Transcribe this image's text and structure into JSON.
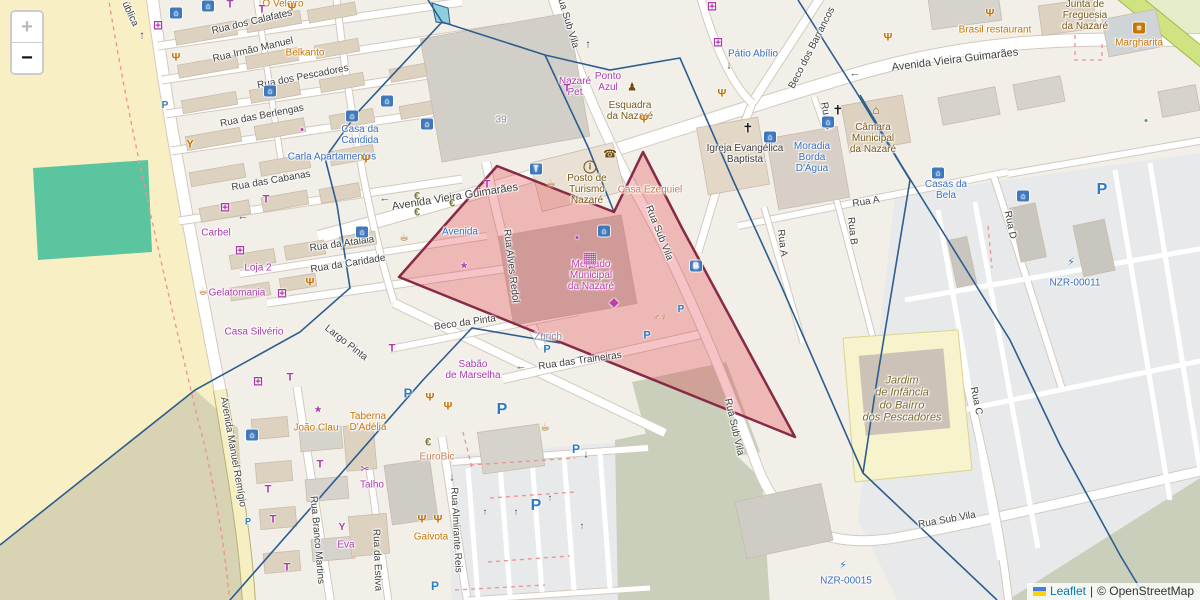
{
  "app": {
    "zoom_in_label": "+",
    "zoom_out_label": "−",
    "attribution": {
      "leaflet": "Leaflet",
      "separator": "|",
      "osm": "© OpenStreetMap"
    }
  },
  "palette": {
    "street": "#3f3f3f",
    "blue": "#3a6fbe",
    "purple": "#ac39ac",
    "orange": "#c77400",
    "brown": "#7a5816",
    "magenta": "#bf3fa8",
    "dark": "#3c3c3c",
    "olive": "#7c6c2c",
    "graylav": "#8a87a0",
    "salmon": "#cc7a52",
    "graynum": "#8f8f8f",
    "bank": "#7c7c3a",
    "pblue": "#2d7cc3",
    "highlight_fill": "rgba(225,55,65,0.30)",
    "highlight_stroke": "#872b45",
    "boundary": "#2d5d8e"
  },
  "icon_defs": {
    "hotel": {
      "glyph": "⌂",
      "fg": "#ffffff",
      "bg": "#3d77bc"
    },
    "taxi": {
      "glyph": "T",
      "fg": "#ffffff",
      "bg": "#3d77bc"
    },
    "bus": {
      "glyph": "B",
      "fg": "#ffffff",
      "bg": "#3d77bc"
    },
    "burger": {
      "glyph": "≡",
      "fg": "#ffffff",
      "bg": "#c77400"
    },
    "shop_clothes": {
      "glyph": "T",
      "fg": "#ac39ac",
      "size": 11
    },
    "shop_grid": {
      "glyph": "⊞",
      "fg": "#ac39ac",
      "size": 12
    },
    "florist": {
      "glyph": "*",
      "fg": "#ac39ac",
      "size": 15
    },
    "scissors": {
      "glyph": "✂",
      "fg": "#ac39ac",
      "size": 11
    },
    "wine": {
      "glyph": "Y",
      "fg": "#ac39ac",
      "size": 10
    },
    "restaurant": {
      "glyph": "Ψ",
      "fg": "#c77400",
      "size": 11
    },
    "cafe": {
      "glyph": "☕",
      "fg": "#a8641e",
      "size": 11
    },
    "bar": {
      "glyph": "Y",
      "fg": "#c77400",
      "size": 11
    },
    "phone": {
      "glyph": "☎",
      "fg": "#734a08",
      "size": 11
    },
    "church": {
      "glyph": "✝",
      "fg": "#1a1a1a",
      "size": 13
    },
    "townhall": {
      "glyph": "⌂",
      "fg": "#734a08",
      "size": 12
    },
    "police": {
      "glyph": "♟",
      "fg": "#734a08",
      "size": 11
    },
    "info": {
      "glyph": "i",
      "fg": "#734a08",
      "size": 9,
      "ring": true
    },
    "atm": {
      "glyph": "€",
      "fg": "#7c7c3a",
      "size": 11
    },
    "wc": {
      "glyph": "♂♀",
      "fg": "#a8641e",
      "size": 10
    },
    "charge": {
      "glyph": "⚡",
      "fg": "#2d7cc3",
      "size": 11
    },
    "fish": {
      "glyph": "◆",
      "fg": "#bf3fa8",
      "size": 12
    },
    "market": {
      "glyph": "▦",
      "fg": "#bf3fa8",
      "size": 15
    },
    "dot": {
      "glyph": "●",
      "fg": "#bf3fa8",
      "size": 7
    },
    "parkP": {
      "glyph": "P",
      "fg": "#2d7cc3",
      "size": 13
    },
    "arrow": {
      "glyph": "←",
      "fg": "#4a4a4a",
      "size": 11
    },
    "lane_arrow": {
      "glyph": "↑",
      "fg": "#333333",
      "size": 9
    }
  },
  "street_labels": [
    {
      "t": "Avenida Vieira Guimarães",
      "x": 455,
      "y": 197,
      "r": -9,
      "s": 11
    },
    {
      "t": "Avenida Vieira Guimarães",
      "x": 955,
      "y": 60,
      "r": -7,
      "s": 11
    },
    {
      "t": "Rua dos Calafates",
      "x": 252,
      "y": 22,
      "r": -13
    },
    {
      "t": "Rua Irmão Manuel",
      "x": 253,
      "y": 50,
      "r": -13
    },
    {
      "t": "Rua dos Pescadores",
      "x": 303,
      "y": 77,
      "r": -11
    },
    {
      "t": "Rua das Berlengas",
      "x": 262,
      "y": 116,
      "r": -11
    },
    {
      "t": "Rua das Cabanas",
      "x": 271,
      "y": 181,
      "r": -10
    },
    {
      "t": "Rua da Atalaia",
      "x": 342,
      "y": 244,
      "r": -8
    },
    {
      "t": "Rua da Caridade",
      "x": 348,
      "y": 264,
      "r": -9
    },
    {
      "t": "Beco da Pinta",
      "x": 465,
      "y": 323,
      "r": -8
    },
    {
      "t": "Largo Pinta",
      "x": 346,
      "y": 343,
      "r": 38
    },
    {
      "t": "Rua das Traineiras",
      "x": 580,
      "y": 361,
      "r": -8
    },
    {
      "t": "Rua Alves Redol",
      "x": 511,
      "y": 266,
      "r": 83
    },
    {
      "t": "Rua Sub Vila",
      "x": 567,
      "y": 20,
      "r": 73
    },
    {
      "t": "Rua Sub Vila",
      "x": 659,
      "y": 233,
      "r": 68
    },
    {
      "t": "Rua Sub Vila",
      "x": 734,
      "y": 427,
      "r": 77
    },
    {
      "t": "Rua Sub Vila",
      "x": 947,
      "y": 520,
      "r": -10
    },
    {
      "t": "Beco dos Barrancos",
      "x": 812,
      "y": 48,
      "r": -63
    },
    {
      "t": "Rua A",
      "x": 866,
      "y": 202,
      "r": -9
    },
    {
      "t": "Rua A",
      "x": 782,
      "y": 243,
      "r": 83
    },
    {
      "t": "Rua B",
      "x": 826,
      "y": 116,
      "r": 80
    },
    {
      "t": "Rua B",
      "x": 852,
      "y": 231,
      "r": 83
    },
    {
      "t": "Rua C",
      "x": 976,
      "y": 401,
      "r": 78
    },
    {
      "t": "Rua D",
      "x": 1010,
      "y": 225,
      "r": 78
    },
    {
      "t": "Avenida Manuel Remígio",
      "x": 233,
      "y": 452,
      "r": 80
    },
    {
      "t": "Rua Branco Martins",
      "x": 317,
      "y": 540,
      "r": 85
    },
    {
      "t": "Rua da Estiva",
      "x": 377,
      "y": 560,
      "r": 88
    },
    {
      "t": "Rua Almirante Reis",
      "x": 456,
      "y": 530,
      "r": 87
    },
    {
      "t": "ública",
      "x": 130,
      "y": 14,
      "r": 65
    }
  ],
  "poi_labels": [
    {
      "t": "Casa da\nCandida",
      "x": 360,
      "y": 135,
      "c": "blue"
    },
    {
      "t": "Carla Apartamentos",
      "x": 332,
      "y": 157,
      "c": "blue"
    },
    {
      "t": "Pátio Abílio",
      "x": 753,
      "y": 54,
      "c": "blue"
    },
    {
      "t": "Moradia\nBorda\nD'Água",
      "x": 812,
      "y": 158,
      "c": "blue"
    },
    {
      "t": "Casas da\nBela",
      "x": 946,
      "y": 190,
      "c": "blue"
    },
    {
      "t": "NZR-00011",
      "x": 1075,
      "y": 283,
      "c": "blue"
    },
    {
      "t": "NZR-00015",
      "x": 846,
      "y": 581,
      "c": "blue"
    },
    {
      "t": "Avenida",
      "x": 460,
      "y": 232,
      "c": "blue"
    },
    {
      "t": "Nazaré\nPet",
      "x": 575,
      "y": 87,
      "c": "purple"
    },
    {
      "t": "Ponto\nAzul",
      "x": 608,
      "y": 82,
      "c": "purple"
    },
    {
      "t": "Belkanto",
      "x": 305,
      "y": 53,
      "c": "orange"
    },
    {
      "t": "Gelatomania",
      "x": 237,
      "y": 293,
      "c": "purple"
    },
    {
      "t": "Casa Silvério",
      "x": 254,
      "y": 332,
      "c": "purple"
    },
    {
      "t": "Loja 2",
      "x": 258,
      "y": 268,
      "c": "purple"
    },
    {
      "t": "Carbel",
      "x": 216,
      "y": 233,
      "c": "purple"
    },
    {
      "t": "Sabão\nde Marselha",
      "x": 473,
      "y": 370,
      "c": "purple"
    },
    {
      "t": "Talho",
      "x": 372,
      "y": 485,
      "c": "purple"
    },
    {
      "t": "Eva",
      "x": 346,
      "y": 545,
      "c": "purple"
    },
    {
      "t": "João Clau",
      "x": 316,
      "y": 428,
      "c": "orange"
    },
    {
      "t": "Taberna\nD'Adélia",
      "x": 368,
      "y": 422,
      "c": "orange"
    },
    {
      "t": "Gaivota",
      "x": 431,
      "y": 537,
      "c": "orange"
    },
    {
      "t": "EuroBic",
      "x": 437,
      "y": 457,
      "c": "salmon"
    },
    {
      "t": "Zurich",
      "x": 548,
      "y": 337,
      "c": "graylav"
    },
    {
      "t": "O Veleiro",
      "x": 283,
      "y": 4,
      "c": "orange"
    },
    {
      "t": "Brasil restaurant",
      "x": 995,
      "y": 30,
      "c": "orange"
    },
    {
      "t": "Margharita",
      "x": 1139,
      "y": 43,
      "c": "orange"
    },
    {
      "t": "Casa Ezequiel",
      "x": 650,
      "y": 190,
      "c": "salmon"
    },
    {
      "t": "Esquadra\nda Nazaré",
      "x": 630,
      "y": 111,
      "c": "brown"
    },
    {
      "t": "Posto de\nTurismo\nNazaré",
      "x": 587,
      "y": 190,
      "c": "brown"
    },
    {
      "t": "Igreja Evangélica\nBaptista",
      "x": 745,
      "y": 154,
      "c": "dark"
    },
    {
      "t": "Câmara\nMunicipal\nda Nazaré",
      "x": 873,
      "y": 139,
      "c": "brown"
    },
    {
      "t": "Junta de\nFreguesia\nda Nazaré",
      "x": 1085,
      "y": 16,
      "c": "brown"
    },
    {
      "t": "Mercado\nMunicipal\nda Nazaré",
      "x": 591,
      "y": 276,
      "c": "magenta"
    },
    {
      "t": "Jardim\nde Infância\ndo Bairro\ndos Pescadores",
      "x": 902,
      "y": 399,
      "c": "olive",
      "it": true,
      "s": 11
    },
    {
      "t": "39",
      "x": 501,
      "y": 120,
      "c": "graynum"
    }
  ],
  "icons": [
    {
      "k": "hotel",
      "x": 176,
      "y": 13
    },
    {
      "k": "hotel",
      "x": 208,
      "y": 6
    },
    {
      "k": "hotel",
      "x": 270,
      "y": 91
    },
    {
      "k": "hotel",
      "x": 352,
      "y": 116
    },
    {
      "k": "hotel",
      "x": 387,
      "y": 101
    },
    {
      "k": "hotel",
      "x": 427,
      "y": 124
    },
    {
      "k": "hotel",
      "x": 604,
      "y": 231
    },
    {
      "k": "hotel",
      "x": 770,
      "y": 137
    },
    {
      "k": "hotel",
      "x": 828,
      "y": 122
    },
    {
      "k": "hotel",
      "x": 938,
      "y": 173
    },
    {
      "k": "hotel",
      "x": 1023,
      "y": 196
    },
    {
      "k": "hotel",
      "x": 252,
      "y": 435
    },
    {
      "k": "hotel",
      "x": 362,
      "y": 232
    },
    {
      "k": "shop_clothes",
      "x": 230,
      "y": 5
    },
    {
      "k": "shop_clothes",
      "x": 262,
      "y": 10
    },
    {
      "k": "shop_clothes",
      "x": 290,
      "y": 378
    },
    {
      "k": "shop_clothes",
      "x": 268,
      "y": 490
    },
    {
      "k": "shop_clothes",
      "x": 273,
      "y": 520
    },
    {
      "k": "shop_clothes",
      "x": 287,
      "y": 568
    },
    {
      "k": "shop_clothes",
      "x": 320,
      "y": 465
    },
    {
      "k": "shop_clothes",
      "x": 392,
      "y": 349
    },
    {
      "k": "shop_clothes",
      "x": 266,
      "y": 200
    },
    {
      "k": "shop_clothes",
      "x": 487,
      "y": 185
    },
    {
      "k": "shop_clothes",
      "x": 567,
      "y": 89
    },
    {
      "k": "shop_grid",
      "x": 158,
      "y": 25
    },
    {
      "k": "shop_grid",
      "x": 225,
      "y": 207
    },
    {
      "k": "shop_grid",
      "x": 240,
      "y": 250
    },
    {
      "k": "shop_grid",
      "x": 258,
      "y": 381
    },
    {
      "k": "shop_grid",
      "x": 282,
      "y": 293
    },
    {
      "k": "shop_grid",
      "x": 712,
      "y": 6
    },
    {
      "k": "shop_grid",
      "x": 718,
      "y": 42
    },
    {
      "k": "florist",
      "x": 464,
      "y": 268
    },
    {
      "k": "florist",
      "x": 318,
      "y": 412
    },
    {
      "k": "scissors",
      "x": 365,
      "y": 470
    },
    {
      "k": "wine",
      "x": 342,
      "y": 528
    },
    {
      "k": "restaurant",
      "x": 292,
      "y": 8
    },
    {
      "k": "restaurant",
      "x": 366,
      "y": 160
    },
    {
      "k": "restaurant",
      "x": 310,
      "y": 283
    },
    {
      "k": "restaurant",
      "x": 430,
      "y": 398
    },
    {
      "k": "restaurant",
      "x": 448,
      "y": 407
    },
    {
      "k": "restaurant",
      "x": 644,
      "y": 120
    },
    {
      "k": "restaurant",
      "x": 990,
      "y": 14
    },
    {
      "k": "restaurant",
      "x": 888,
      "y": 38
    },
    {
      "k": "restaurant",
      "x": 422,
      "y": 520
    },
    {
      "k": "restaurant",
      "x": 438,
      "y": 520
    },
    {
      "k": "restaurant",
      "x": 176,
      "y": 58
    },
    {
      "k": "restaurant",
      "x": 722,
      "y": 94
    },
    {
      "k": "cafe",
      "x": 203,
      "y": 292
    },
    {
      "k": "cafe",
      "x": 404,
      "y": 238
    },
    {
      "k": "cafe",
      "x": 551,
      "y": 184
    },
    {
      "k": "cafe",
      "x": 545,
      "y": 428
    },
    {
      "k": "bar",
      "x": 190,
      "y": 145
    },
    {
      "k": "phone",
      "x": 610,
      "y": 155
    },
    {
      "k": "church",
      "x": 748,
      "y": 128
    },
    {
      "k": "church",
      "x": 838,
      "y": 110
    },
    {
      "k": "townhall",
      "x": 876,
      "y": 110
    },
    {
      "k": "police",
      "x": 632,
      "y": 88
    },
    {
      "k": "info",
      "x": 590,
      "y": 167
    },
    {
      "k": "taxi",
      "x": 536,
      "y": 169
    },
    {
      "k": "bus",
      "x": 696,
      "y": 266
    },
    {
      "k": "burger",
      "x": 1139,
      "y": 28
    },
    {
      "k": "atm",
      "x": 417,
      "y": 197
    },
    {
      "k": "atm",
      "x": 417,
      "y": 213
    },
    {
      "k": "atm",
      "x": 428,
      "y": 443
    },
    {
      "k": "atm",
      "x": 452,
      "y": 204
    },
    {
      "k": "wc",
      "x": 660,
      "y": 318
    },
    {
      "k": "charge",
      "x": 1071,
      "y": 263
    },
    {
      "k": "charge",
      "x": 843,
      "y": 566
    },
    {
      "k": "fish",
      "x": 614,
      "y": 302
    },
    {
      "k": "market",
      "x": 590,
      "y": 258
    },
    {
      "k": "dot",
      "x": 302,
      "y": 130
    },
    {
      "k": "dot",
      "x": 577,
      "y": 238,
      "c": "#9a4fb5"
    },
    {
      "k": "dot",
      "x": 1146,
      "y": 121,
      "c": "#55a055"
    },
    {
      "k": "parkP",
      "x": 165,
      "y": 106,
      "s": 10
    },
    {
      "k": "parkP",
      "x": 408,
      "y": 393,
      "s": 13
    },
    {
      "k": "parkP",
      "x": 502,
      "y": 410,
      "s": 16
    },
    {
      "k": "parkP",
      "x": 536,
      "y": 506,
      "s": 16
    },
    {
      "k": "parkP",
      "x": 576,
      "y": 449,
      "s": 12
    },
    {
      "k": "parkP",
      "x": 647,
      "y": 336,
      "s": 11
    },
    {
      "k": "parkP",
      "x": 1102,
      "y": 190,
      "s": 16
    },
    {
      "k": "parkP",
      "x": 435,
      "y": 586,
      "s": 12
    },
    {
      "k": "parkP",
      "x": 248,
      "y": 522,
      "s": 9
    },
    {
      "k": "parkP",
      "x": 547,
      "y": 350,
      "s": 11
    },
    {
      "k": "parkP",
      "x": 681,
      "y": 310,
      "s": 10
    },
    {
      "k": "arrow",
      "x": 385,
      "y": 199
    },
    {
      "k": "arrow",
      "x": 855,
      "y": 74
    },
    {
      "k": "arrow",
      "x": 521,
      "y": 367
    },
    {
      "k": "arrow",
      "x": 243,
      "y": 217
    },
    {
      "k": "arrow",
      "x": 592,
      "y": 267
    },
    {
      "k": "arrow",
      "g": "↑",
      "x": 588,
      "y": 45
    },
    {
      "k": "arrow",
      "g": "↑",
      "x": 142,
      "y": 36
    },
    {
      "k": "arrow",
      "g": "↓",
      "x": 729,
      "y": 66
    },
    {
      "k": "arrow",
      "g": "↓",
      "x": 586,
      "y": 455
    },
    {
      "k": "arrow",
      "g": "↓",
      "x": 452,
      "y": 478
    },
    {
      "k": "lane_arrow",
      "x": 485,
      "y": 512
    },
    {
      "k": "lane_arrow",
      "x": 516,
      "y": 512
    },
    {
      "k": "lane_arrow",
      "x": 550,
      "y": 498
    },
    {
      "k": "lane_arrow",
      "x": 582,
      "y": 526
    }
  ],
  "overlays": {
    "highlight_polygon": {
      "points": [
        [
          399,
          277
        ],
        [
          497,
          166
        ],
        [
          614,
          212
        ],
        [
          643,
          152
        ],
        [
          682,
          228
        ],
        [
          795,
          437
        ]
      ]
    },
    "boundary_lines": [
      [
        [
          428,
          0
        ],
        [
          442,
          22
        ],
        [
          358,
          112
        ],
        [
          325,
          158
        ],
        [
          337,
          205
        ],
        [
          350,
          288
        ],
        [
          300,
          332
        ],
        [
          195,
          390
        ],
        [
          0,
          545
        ]
      ],
      [
        [
          442,
          22
        ],
        [
          545,
          55
        ],
        [
          610,
          70
        ],
        [
          680,
          58
        ],
        [
          733,
          180
        ],
        [
          780,
          283
        ],
        [
          863,
          473
        ],
        [
          997,
          600
        ]
      ],
      [
        [
          545,
          55
        ],
        [
          588,
          147
        ],
        [
          614,
          212
        ]
      ],
      [
        [
          798,
          0
        ],
        [
          855,
          90
        ],
        [
          910,
          180
        ],
        [
          877,
          380
        ],
        [
          863,
          473
        ]
      ],
      [
        [
          860,
          95
        ],
        [
          900,
          163
        ],
        [
          1010,
          340
        ],
        [
          1060,
          445
        ],
        [
          1120,
          555
        ],
        [
          1147,
          600
        ]
      ],
      [
        [
          560,
          343
        ],
        [
          472,
          328
        ],
        [
          423,
          380
        ],
        [
          230,
          600
        ]
      ]
    ],
    "pond": {
      "points": [
        [
          432,
          3
        ],
        [
          448,
          8
        ],
        [
          450,
          24
        ],
        [
          436,
          22
        ]
      ],
      "fill": "#8ecfdb"
    }
  }
}
